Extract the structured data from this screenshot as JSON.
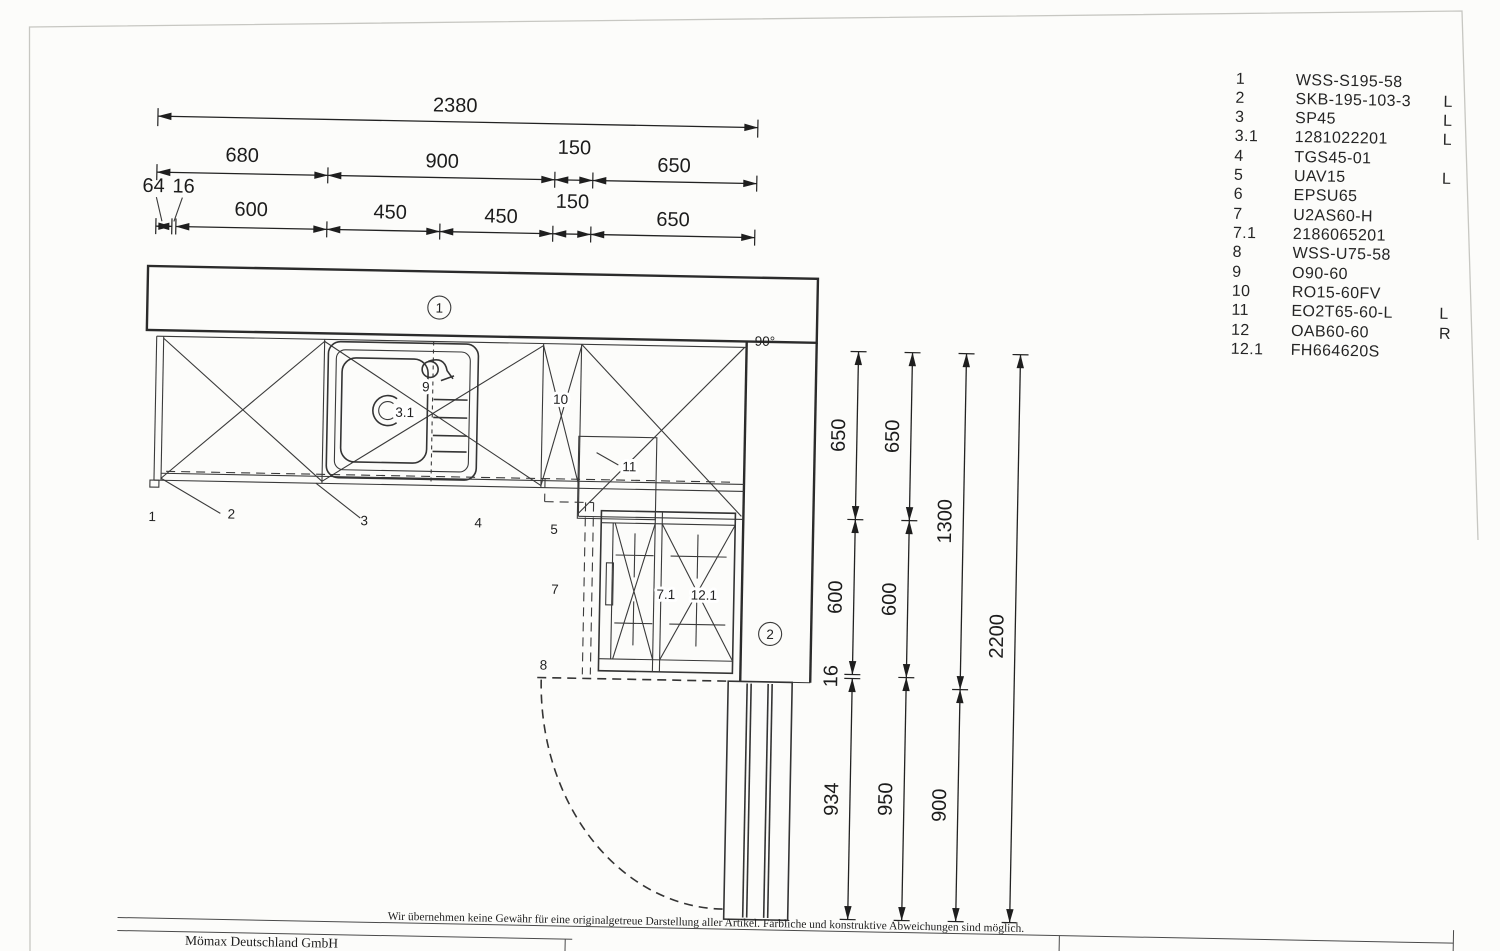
{
  "colors": {
    "door_fill": "#d8d8d5",
    "line": "#2b2b2b",
    "paper": "#fcfcfa"
  },
  "top_dims": {
    "total": "2380",
    "row2": [
      "680",
      "900",
      "150",
      "650"
    ],
    "row3": [
      "64",
      "16",
      "600",
      "450",
      "450",
      "150",
      "650"
    ]
  },
  "right_dims": {
    "col1": [
      "650",
      "600",
      "16",
      "934"
    ],
    "col2": [
      "650",
      "600",
      "950"
    ],
    "col3": [
      "1300",
      "900"
    ],
    "col4": [
      "2200"
    ]
  },
  "plan": {
    "angle": "90°",
    "bubble1": "1",
    "bubble2": "2",
    "labels": {
      "n1": "1",
      "n2": "2",
      "n3": "3",
      "n4": "4",
      "n5": "5",
      "n7": "7",
      "n8": "8",
      "n9": "9",
      "n3_1": "3.1",
      "n10": "10",
      "n11": "11",
      "n7_1": "7.1",
      "n12_1": "12.1"
    }
  },
  "parts": [
    {
      "num": "1",
      "code": "WSS-S195-58",
      "side": ""
    },
    {
      "num": "2",
      "code": "SKB-195-103-3",
      "side": "L"
    },
    {
      "num": "3",
      "code": "SP45",
      "side": "L"
    },
    {
      "num": "3.1",
      "code": "1281022201",
      "side": "L"
    },
    {
      "num": "4",
      "code": "TGS45-01",
      "side": ""
    },
    {
      "num": "5",
      "code": "UAV15",
      "side": "L"
    },
    {
      "num": "6",
      "code": "EPSU65",
      "side": ""
    },
    {
      "num": "7",
      "code": "U2AS60-H",
      "side": ""
    },
    {
      "num": "7.1",
      "code": "2186065201",
      "side": ""
    },
    {
      "num": "8",
      "code": "WSS-U75-58",
      "side": ""
    },
    {
      "num": "9",
      "code": "O90-60",
      "side": ""
    },
    {
      "num": "10",
      "code": "RO15-60FV",
      "side": ""
    },
    {
      "num": "11",
      "code": "EO2T65-60-L",
      "side": "L"
    },
    {
      "num": "12",
      "code": "OAB60-60",
      "side": "R"
    },
    {
      "num": "12.1",
      "code": "FH664620S",
      "side": ""
    }
  ],
  "footer": {
    "disclaimer": "Wir übernehmen keine Gewähr für eine originalgetreue Darstellung aller Artikel. Farbliche und konstruktive Abweichungen sind möglich.",
    "company": "Mömax Deutschland GmbH",
    "address_partial": "Flick-Str."
  }
}
